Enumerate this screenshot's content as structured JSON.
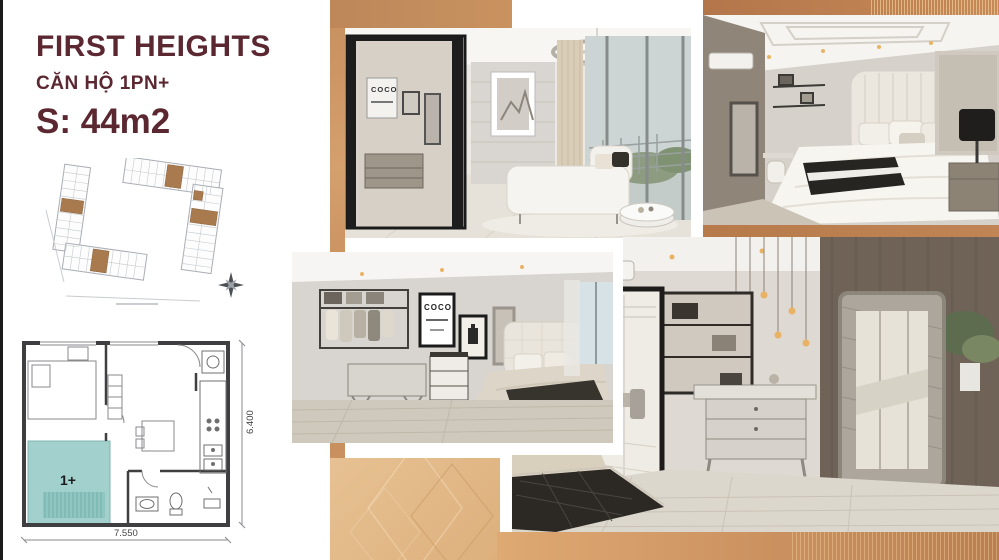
{
  "slide": {
    "background": "#ffffff",
    "edge_bar_color": "#1b1b1b"
  },
  "header": {
    "title": "FIRST HEIGHTS",
    "subtitle": "CĂN HỘ 1PN+",
    "area": "S: 44m2",
    "text_color": "#5b2831"
  },
  "site_plan": {
    "highlight_color": "#a87a4e",
    "outline_color": "#a9adb3"
  },
  "floor_plan": {
    "room_label": "1+",
    "width_label": "7.550",
    "height_label": "6.400",
    "highlight_color": "#a2d0cd",
    "wall_color": "#3f3f41"
  },
  "photos": {
    "living_room": {
      "poster_text": "COCO"
    },
    "bedroom_angle": {
      "poster_text": "COCO"
    }
  },
  "decor": {
    "copper": "#b87c4e",
    "gold": "#cf9a66",
    "gold_light": "#e3ba8a"
  }
}
